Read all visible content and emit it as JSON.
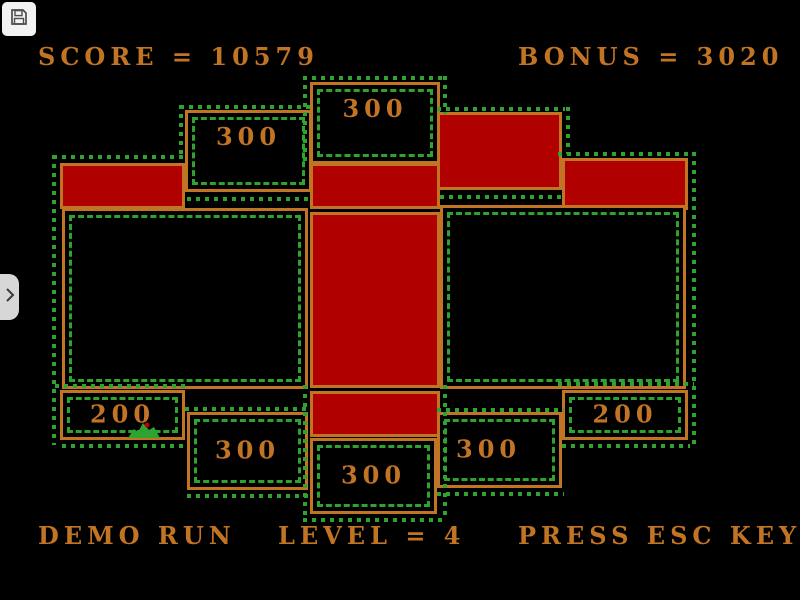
{
  "hud": {
    "score": "SCORE = 10579",
    "bonus": "BONUS = 3020",
    "demo": "DEMO RUN",
    "level": "LEVEL = 4",
    "esc": "PRESS ESC KEY"
  },
  "colors": {
    "orange": "#C27425",
    "red": "#B00000",
    "green": "#2FA32F",
    "bg": "#000000"
  },
  "overlay": {
    "save_button_icon": "floppy-disk-icon",
    "expand_tab_icon": "chevron-right-icon"
  },
  "sprite": {
    "name": "green-creature",
    "body_color": "#2FA32F",
    "eye_color": "#C00000"
  },
  "board": {
    "boxes": [
      {
        "name": "center-top-bonus-box",
        "kind": "black",
        "x": 310,
        "y": 82,
        "w": 130,
        "h": 82,
        "label": "300",
        "label_pos": "top"
      },
      {
        "name": "left-top-bonus-box",
        "kind": "black",
        "x": 185,
        "y": 110,
        "w": 127,
        "h": 82,
        "label": "300",
        "label_pos": "top"
      },
      {
        "name": "right-top-claimed-box",
        "kind": "red",
        "x": 437,
        "y": 112,
        "w": 125,
        "h": 78
      },
      {
        "name": "left-claimed-bar",
        "kind": "red",
        "x": 60,
        "y": 163,
        "w": 125,
        "h": 46
      },
      {
        "name": "right-claimed-bar",
        "kind": "red",
        "x": 562,
        "y": 158,
        "w": 126,
        "h": 52
      },
      {
        "name": "center-claimed-band-top",
        "kind": "red",
        "x": 310,
        "y": 163,
        "w": 130,
        "h": 46
      },
      {
        "name": "center-claimed-column",
        "kind": "red",
        "x": 310,
        "y": 212,
        "w": 130,
        "h": 176
      },
      {
        "name": "center-claimed-band-bottom",
        "kind": "red",
        "x": 310,
        "y": 391,
        "w": 130,
        "h": 46
      },
      {
        "name": "left-open-region",
        "kind": "black",
        "x": 62,
        "y": 208,
        "w": 246,
        "h": 181
      },
      {
        "name": "right-open-region",
        "kind": "black",
        "x": 440,
        "y": 205,
        "w": 246,
        "h": 184
      },
      {
        "name": "left-200-bonus-box",
        "kind": "black",
        "x": 60,
        "y": 390,
        "w": 125,
        "h": 50,
        "label": "200",
        "label_pos": "center"
      },
      {
        "name": "right-200-bonus-box",
        "kind": "black",
        "x": 562,
        "y": 390,
        "w": 126,
        "h": 50,
        "label": "200",
        "label_pos": "center"
      },
      {
        "name": "left-bottom-bonus-box",
        "kind": "black",
        "x": 187,
        "y": 412,
        "w": 121,
        "h": 78,
        "label": "300",
        "label_pos": "center"
      },
      {
        "name": "right-bottom-bonus-box",
        "kind": "black",
        "x": 437,
        "y": 412,
        "w": 125,
        "h": 76,
        "label": "300",
        "label_pos": "left-center"
      },
      {
        "name": "center-bottom-bonus-box",
        "kind": "black",
        "x": 310,
        "y": 438,
        "w": 127,
        "h": 76,
        "label": "300",
        "label_pos": "center"
      }
    ],
    "dotted_segments": [
      {
        "dir": "h",
        "x": 53,
        "y": 155,
        "len": 134
      },
      {
        "dir": "h",
        "x": 558,
        "y": 152,
        "len": 134
      },
      {
        "dir": "v",
        "x": 52,
        "y": 155,
        "len": 290
      },
      {
        "dir": "v",
        "x": 692,
        "y": 152,
        "len": 292
      },
      {
        "dir": "h",
        "x": 180,
        "y": 105,
        "len": 133
      },
      {
        "dir": "v",
        "x": 179,
        "y": 105,
        "len": 52
      },
      {
        "dir": "h",
        "x": 437,
        "y": 107,
        "len": 128
      },
      {
        "dir": "v",
        "x": 566,
        "y": 107,
        "len": 47
      },
      {
        "dir": "h",
        "x": 303,
        "y": 76,
        "len": 144
      },
      {
        "dir": "v",
        "x": 303,
        "y": 76,
        "len": 90
      },
      {
        "dir": "v",
        "x": 443,
        "y": 76,
        "len": 38
      },
      {
        "dir": "v",
        "x": 303,
        "y": 385,
        "len": 133
      },
      {
        "dir": "v",
        "x": 443,
        "y": 385,
        "len": 133
      },
      {
        "dir": "h",
        "x": 303,
        "y": 518,
        "len": 144
      },
      {
        "dir": "h",
        "x": 55,
        "y": 384,
        "len": 132
      },
      {
        "dir": "h",
        "x": 558,
        "y": 382,
        "len": 136
      },
      {
        "dir": "h",
        "x": 185,
        "y": 407,
        "len": 125
      },
      {
        "dir": "h",
        "x": 437,
        "y": 408,
        "len": 127
      },
      {
        "dir": "h",
        "x": 187,
        "y": 494,
        "len": 123
      },
      {
        "dir": "h",
        "x": 437,
        "y": 492,
        "len": 127
      },
      {
        "dir": "h",
        "x": 62,
        "y": 444,
        "len": 125
      },
      {
        "dir": "h",
        "x": 562,
        "y": 444,
        "len": 128
      },
      {
        "dir": "h",
        "x": 440,
        "y": 195,
        "len": 122
      },
      {
        "dir": "h",
        "x": 187,
        "y": 197,
        "len": 121
      }
    ]
  }
}
